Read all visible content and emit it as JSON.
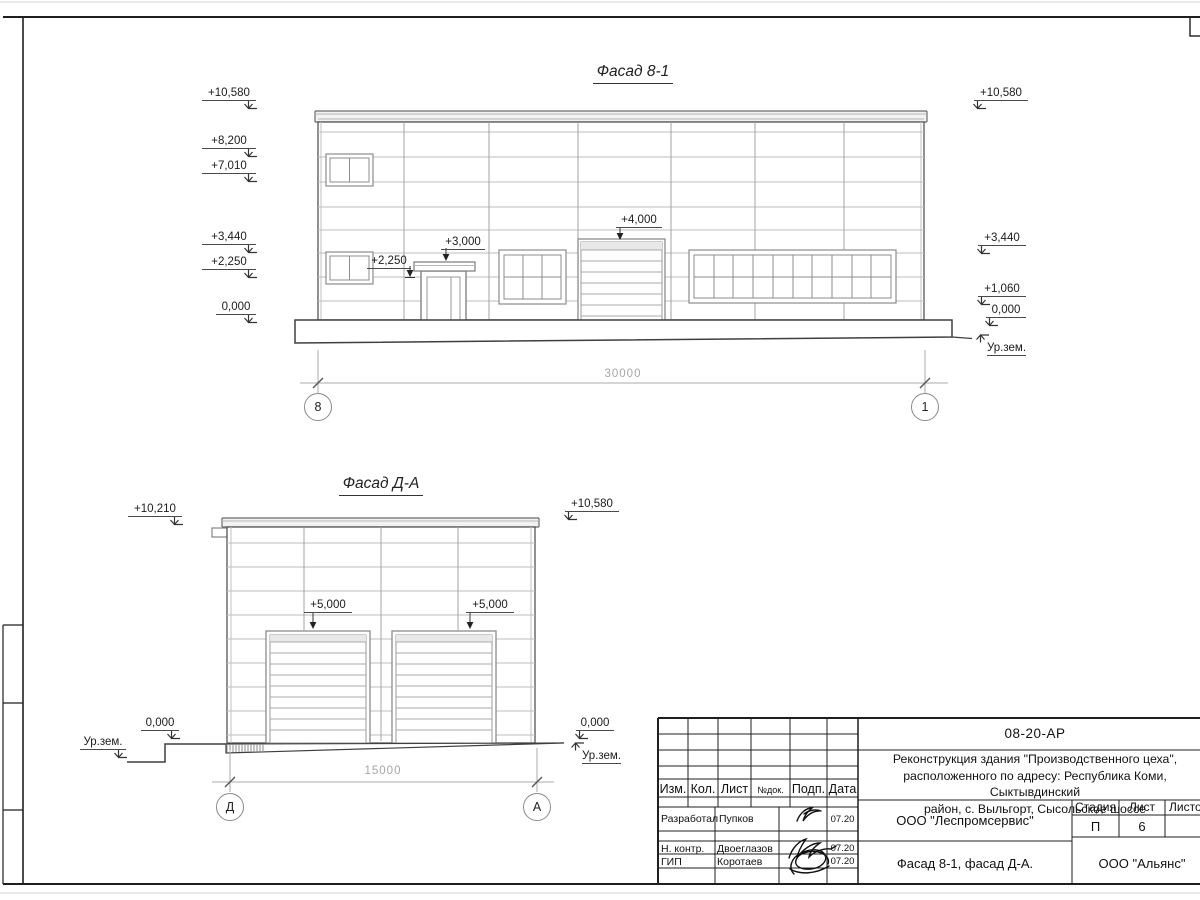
{
  "facade1": {
    "title": "Фасад 8-1",
    "left_marks": [
      "+10,580",
      "+8,200",
      "+7,010",
      "+3,440",
      "+2,250",
      "0,000"
    ],
    "right_marks": [
      "+10,580",
      "+3,440",
      "+1,060",
      "0,000"
    ],
    "ground_label": "Ур.зем.",
    "gate_mark": "+4,000",
    "door_canopy_mark": "+3,000",
    "door_side_mark": "+2,250",
    "dimension": "30000",
    "axis_left": "8",
    "axis_right": "1"
  },
  "facade2": {
    "title": "Фасад Д-А",
    "left_mark": "+10,210",
    "right_mark": "+10,580",
    "gate_mark_left": "+5,000",
    "gate_mark_right": "+5,000",
    "zero_left": "0,000",
    "zero_right": "0,000",
    "ground_left": "Ур.зем.",
    "ground_right": "Ур.зем.",
    "dimension": "15000",
    "axis_left": "Д",
    "axis_right": "А"
  },
  "titleblock": {
    "doc_number": "08-20-АР",
    "project_line1": "Реконструкция здания \"Производственного цеха\",",
    "project_line2": "расположенного по адресу: Республика Коми, Сыктывдинский",
    "project_line3": "район, с. Выльгорт, Сысольское шоссе",
    "cols": [
      "Изм.",
      "Кол.",
      "Лист",
      "№док.",
      "Подп.",
      "Дата"
    ],
    "rows": [
      {
        "label": "Разработал",
        "name": "Пупков",
        "date": "07.20"
      },
      {
        "label": "Н. контр.",
        "name": "Двоеглазов",
        "date": "07.20"
      },
      {
        "label": "ГИП",
        "name": "Коротаев",
        "date": "07.20"
      }
    ],
    "org1": "ООО \"Леспромсервис\"",
    "sheet_title": "Фасад 8-1, фасад Д-А.",
    "stage_label": "Стадия",
    "list_label": "Лист",
    "listov_label": "Листов",
    "stage_value": "П",
    "list_value": "6",
    "org2": "ООО \"Альянс\""
  }
}
